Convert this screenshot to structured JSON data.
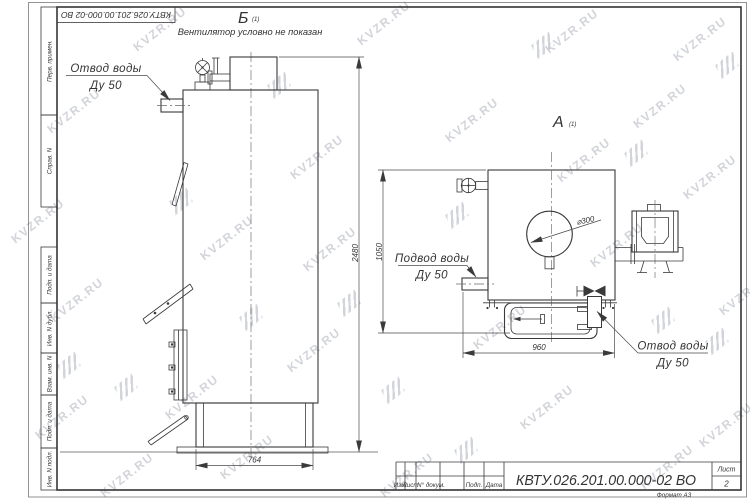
{
  "watermark": {
    "text": "KVZR.RU"
  },
  "sheet": {
    "doc_number": "КВТУ.026.201.00.000-02  ВО",
    "format_note": "Формат А3",
    "sheet_label": "Лист",
    "sheet_number": "2",
    "revision_columns": [
      "Изм.",
      "Лист",
      "N° докум.",
      "Подп.",
      "Дата"
    ],
    "side_fields": [
      "Перв. примен.",
      "Справ. N",
      "Подп. и дата",
      "Инв. N дубл.",
      "Взам. инв. N",
      "Подп. и дата",
      "Инв. N подл."
    ]
  },
  "view_b": {
    "label": "Б",
    "sub": "(1)",
    "note": "Вентилятор условно не показан",
    "callout_outlet_l1": "Отвод воды",
    "callout_outlet_l2": "Ду 50",
    "dim_height": "2480",
    "dim_width": "764"
  },
  "view_a": {
    "label": "А",
    "sub": "(1)",
    "callout_inlet_l1": "Подвод воды",
    "callout_inlet_l2": "Ду 50",
    "callout_outlet_l1": "Отвод воды",
    "callout_outlet_l2": "Ду 50",
    "dim_height": "1050",
    "dim_width": "960",
    "dim_circle": "⌀300"
  }
}
